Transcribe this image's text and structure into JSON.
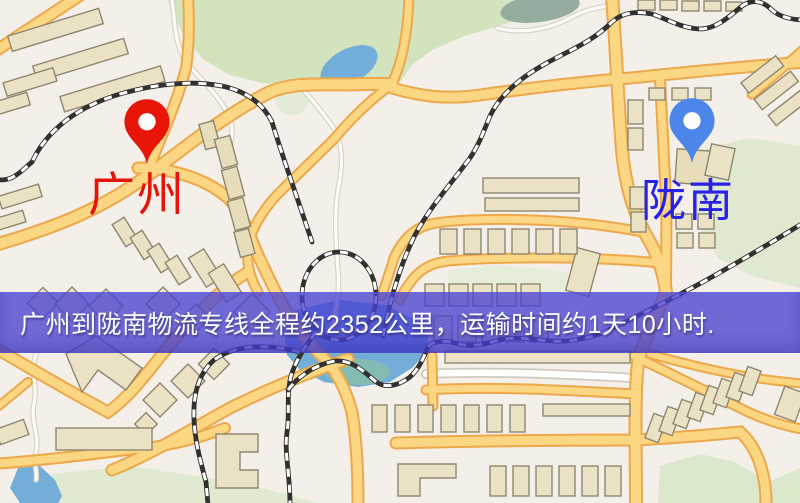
{
  "map": {
    "origin": {
      "name": "广州",
      "pin_icon": "red-map-pin",
      "pin_color": "#e81508",
      "label_color": "#e4140c"
    },
    "destination": {
      "name": "陇南",
      "pin_icon": "blue-map-pin",
      "pin_color": "#4c86e9",
      "label_color": "#2a21e6"
    },
    "style_colors": {
      "background": "#f4efe8",
      "park_green": "#d3e3bd",
      "water_blue": "#73add8",
      "road_fill": "#fcd783",
      "road_casing": "#eca84b"
    }
  },
  "banner": {
    "text": "广州到陇南物流专线全程约2352公里，运输时间约1天10小时.",
    "background_color": "#4942d1",
    "text_color": "#ffffff",
    "distance_km": "2352",
    "duration": "1天10小时"
  }
}
